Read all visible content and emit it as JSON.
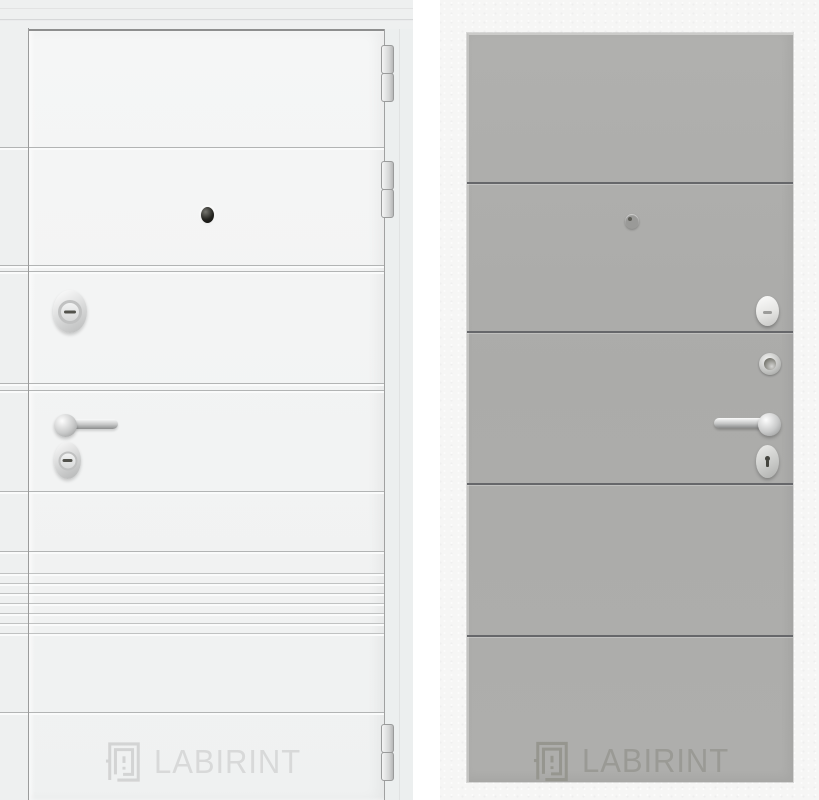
{
  "brand": {
    "name": "LABIRINT"
  },
  "left_door": {
    "brand_label": "LABIRINT",
    "finish_color": "#f3f4f4",
    "hardware_icons": [
      "peephole-icon",
      "security-escutcheon-icon",
      "lever-handle-icon",
      "key-cylinder-icon",
      "hinge-icon",
      "labirint-logo-icon"
    ]
  },
  "right_door": {
    "brand_label": "LABIRINT",
    "panel_color": "#adadab",
    "hardware_icons": [
      "peephole-icon",
      "thumbturn-icon",
      "night-latch-icon",
      "lever-handle-icon",
      "keyhole-escutcheon-icon",
      "labirint-logo-icon"
    ]
  },
  "colors": {
    "left_wall": "#eef0f0",
    "left_leaf": "#f3f4f4",
    "right_wall": "#f6f6f5",
    "right_panel": "#adadab",
    "panel_seam": "#66676a",
    "chrome": "#c9cacb",
    "logo_on_white": "#d8d9d9",
    "logo_on_grey": "#9a9a95"
  }
}
